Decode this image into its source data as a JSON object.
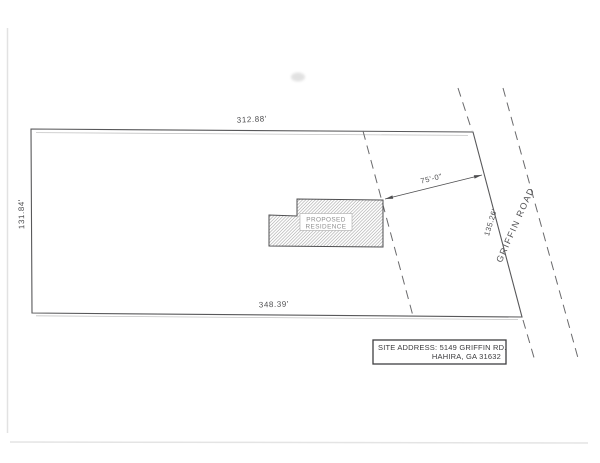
{
  "page": {
    "background_color": "#ffffff",
    "line_color": "#58585a"
  },
  "site_plan": {
    "boundary": {
      "top_dimension": "312.88'",
      "left_dimension": "131.84'",
      "bottom_dimension": "348.39'",
      "right_dimension": "135.26'"
    },
    "building": {
      "label_line1": "PROPOSED",
      "label_line2": "RESIDENCE"
    },
    "front_setback_dimension": "75'-0\"",
    "road_name": "GRIFFIN ROAD",
    "title_block": {
      "line1": "SITE ADDRESS: 5149 GRIFFIN RD.",
      "line2": "HAHIRA, GA 31632"
    }
  }
}
